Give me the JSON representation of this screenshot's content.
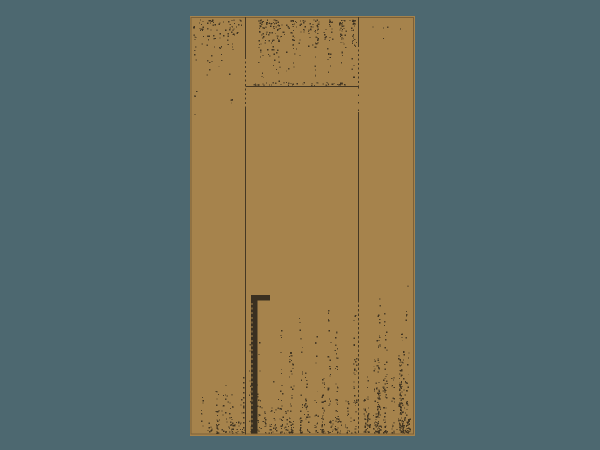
{
  "title": "Wooden door illustration",
  "canvas": {
    "width": 600,
    "height": 450
  },
  "colors": {
    "background": "#4d6870",
    "wood": "#a6834c",
    "wood_edge": "#7c6037",
    "line": "#453823",
    "handle": "#3a3021",
    "speck": "#3c3120"
  },
  "door": {
    "x": 190,
    "y": 16,
    "width": 225,
    "height": 420,
    "dividers": [
      {
        "x": 245.5,
        "segments": [
          [
            17,
            57,
            ""
          ],
          [
            57,
            107,
            "2 2.5"
          ],
          [
            107,
            434.5,
            ""
          ]
        ]
      },
      {
        "x": 358.5,
        "segments": [
          [
            17,
            45,
            ""
          ],
          [
            45,
            87,
            "2 2.5"
          ],
          [
            87,
            112,
            "1.5 6"
          ],
          [
            112,
            300,
            ""
          ],
          [
            300,
            434.5,
            "2.5 2"
          ]
        ]
      }
    ],
    "extra_dotted_lines": [
      {
        "x": 243.8,
        "y1": 377,
        "y2": 433,
        "dash": "1.5 3.5"
      }
    ],
    "lintel": {
      "x1": 245.5,
      "x2": 359,
      "y": 86.5
    },
    "handle": {
      "cap": {
        "x": 251,
        "w": 19,
        "y1": 295,
        "y2": 300.5
      },
      "bar": {
        "x": 251,
        "w": 6.5,
        "y1": 295,
        "y2": 433.5
      },
      "notch_line": {
        "x": 252,
        "y1": 303,
        "y2": 430,
        "dash": "2 2.6"
      }
    }
  },
  "texture": {
    "seed": 1337,
    "regions": [
      {
        "type": "hang",
        "x1": 194,
        "x2": 244,
        "y0": 20,
        "hMin": 15,
        "hMax": 130,
        "bias": 2.2,
        "cols": 26,
        "dens": 0.16
      },
      {
        "type": "hang",
        "x1": 249,
        "x2": 357,
        "y0": 20,
        "hMin": 20,
        "hMax": 66,
        "bias": 1.6,
        "cols": 46,
        "dens": 0.18
      },
      {
        "type": "scatter",
        "x1": 248,
        "x2": 356,
        "y1": 82.5,
        "y2": 86,
        "n": 48
      },
      {
        "type": "scatter",
        "x1": 362,
        "x2": 402,
        "y1": 22,
        "y2": 40,
        "n": 5
      },
      {
        "type": "rise",
        "x1": 202,
        "x2": 244,
        "y0": 433,
        "hMin": 8,
        "hMax": 55,
        "bias": 2.0,
        "cols": 20,
        "dens": 0.28
      },
      {
        "type": "rise",
        "x1": 249,
        "x2": 357,
        "y0": 433,
        "hMin": 10,
        "hMax": 135,
        "bias": 2.6,
        "cols": 48,
        "dens": 0.24
      },
      {
        "type": "rise",
        "x1": 361,
        "x2": 412,
        "y0": 433,
        "hMin": 12,
        "hMax": 150,
        "bias": 2.2,
        "cols": 30,
        "dens": 0.3
      }
    ]
  }
}
